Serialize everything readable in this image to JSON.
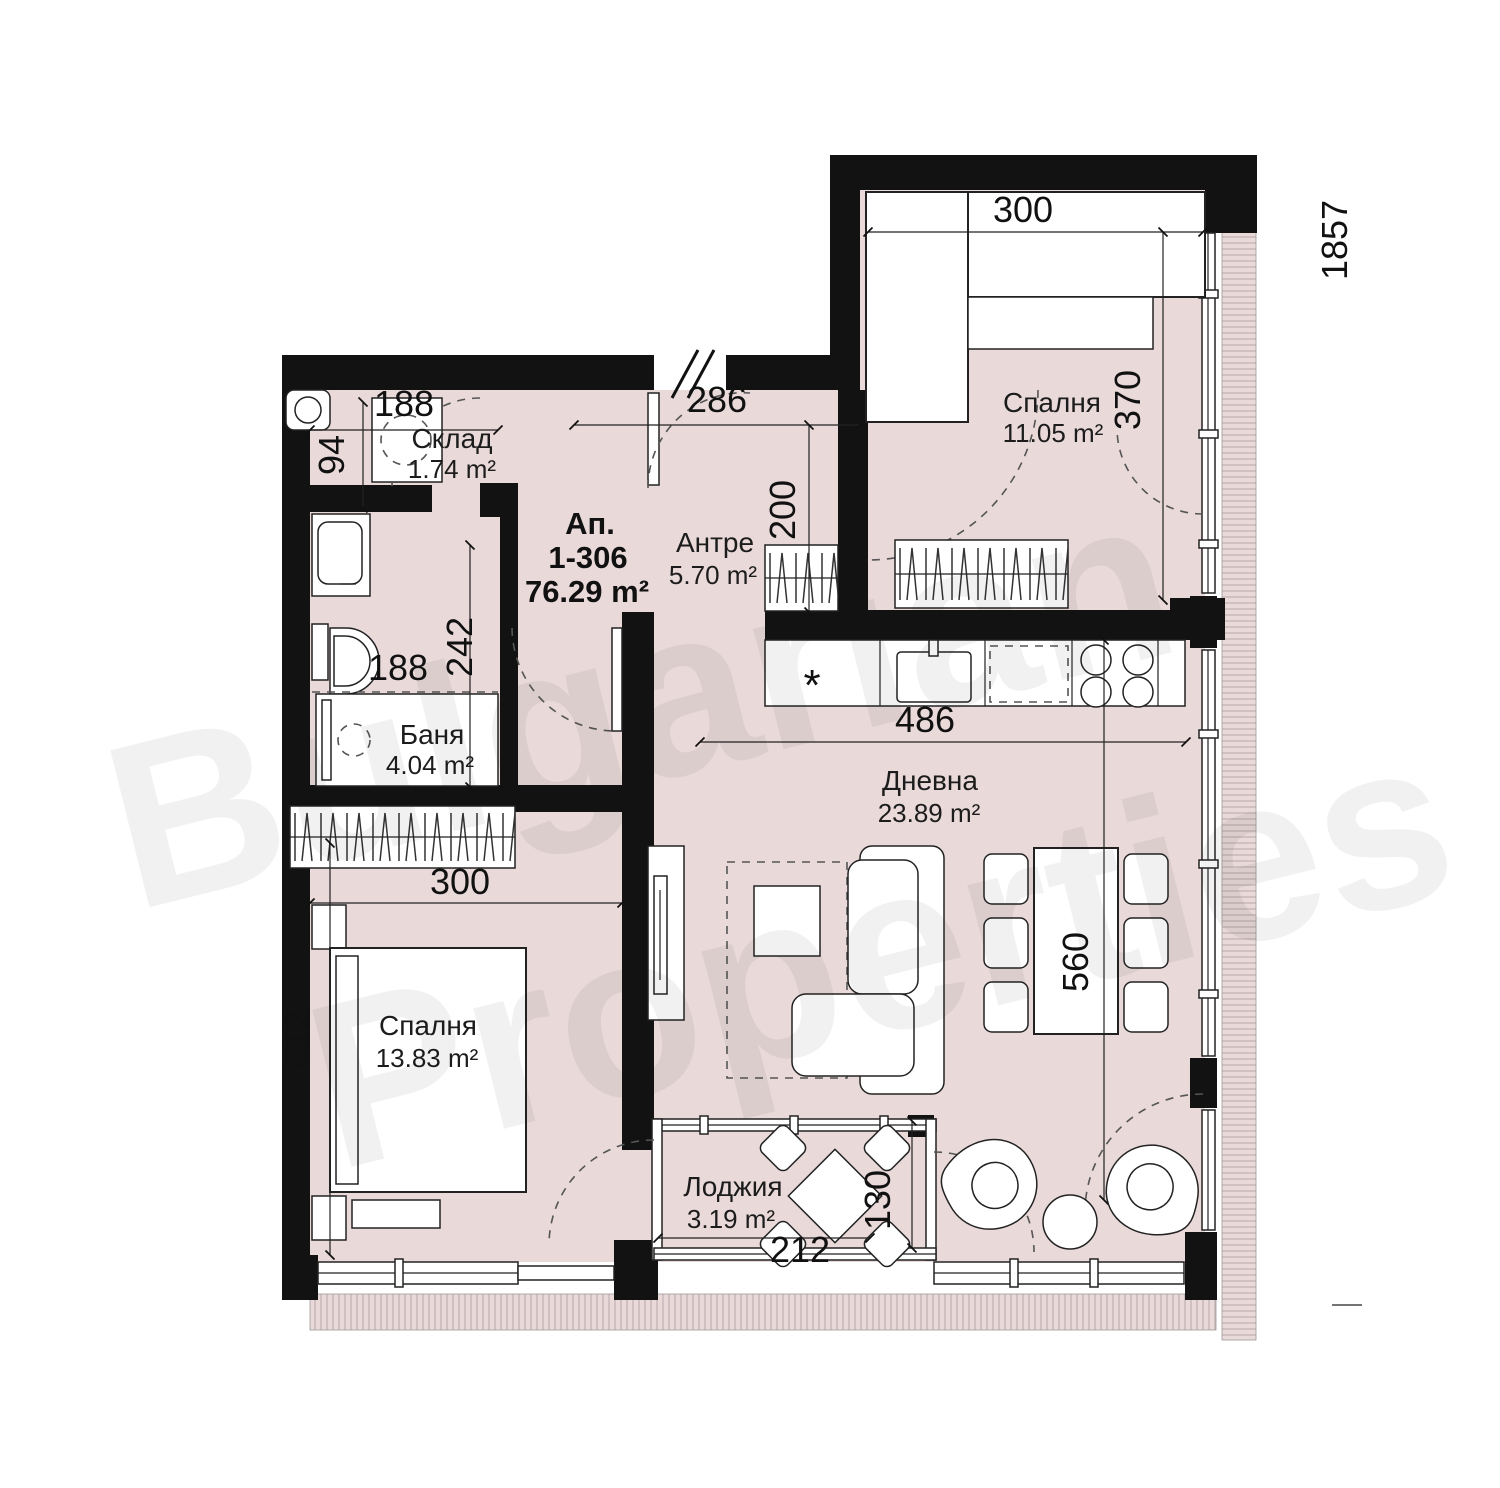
{
  "title": {
    "prefix": "Ап.",
    "number": "1-306",
    "total_area": "76.29 m²"
  },
  "rooms": {
    "storage": {
      "name": "Склад",
      "area": "1.74 m²"
    },
    "hall": {
      "name": "Антре",
      "area": "5.70 m²"
    },
    "bedroom1": {
      "name": "Спалня",
      "area": "11.05 m²"
    },
    "bath": {
      "name": "Баня",
      "area": "4.04 m²"
    },
    "living": {
      "name": "Дневна",
      "area": "23.89 m²"
    },
    "bedroom2": {
      "name": "Спалня",
      "area": "13.83 m²"
    },
    "loggia": {
      "name": "Лоджия",
      "area": "3.19 m²"
    }
  },
  "dims": {
    "storage_w": "188",
    "storage_h": "94",
    "hall_w": "286",
    "hall_h": "200",
    "bed1_w": "300",
    "bed1_h": "370",
    "bath_h": "242",
    "bath_w": "188",
    "kitchen_w": "486",
    "bed2_w": "300",
    "bed2_h": "412",
    "living_h": "560",
    "loggia_h": "130",
    "loggia_w": "212",
    "overall": "1857"
  },
  "kitchen": {
    "fridge_mark": "*"
  },
  "watermark": {
    "word1": "Bulgarian",
    "word2": "Properties"
  },
  "colors": {
    "floor": "#e9d9d9",
    "wall": "#121212",
    "line": "#222222",
    "hatch": "#c2b2b4",
    "text": "#111111"
  }
}
